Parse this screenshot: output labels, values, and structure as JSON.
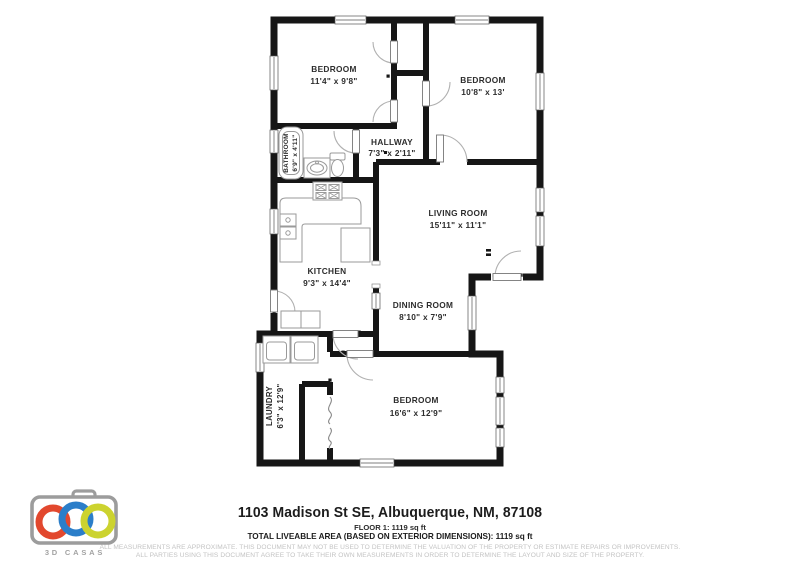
{
  "floor_plan": {
    "rooms": [
      {
        "name": "BEDROOM",
        "dims": "11'4\" x 9'8\""
      },
      {
        "name": "BEDROOM",
        "dims": "10'8\" x 13'"
      },
      {
        "name": "BATHROOM",
        "dims": "6'9\" x 4'11\""
      },
      {
        "name": "HALLWAY",
        "dims": "7'3\" x 2'11\""
      },
      {
        "name": "LIVING ROOM",
        "dims": "15'11\" x 11'1\""
      },
      {
        "name": "KITCHEN",
        "dims": "9'3\" x 14'4\""
      },
      {
        "name": "DINING ROOM",
        "dims": "8'10\" x 7'9\""
      },
      {
        "name": "LAUNDRY",
        "dims": "6'3\" x 12'9\""
      },
      {
        "name": "BEDROOM",
        "dims": "16'6\" x 12'9\""
      }
    ],
    "wall_color": "#161616"
  },
  "footer": {
    "address": "1103 Madison St SE, Albuquerque, NM, 87108",
    "floor_line": "FLOOR 1: 1119 sq ft",
    "total_line": "TOTAL LIVEABLE AREA (BASED ON EXTERIOR DIMENSIONS): 1119 sq ft",
    "disclaimer_line1": "ALL MEASUREMENTS ARE APPROXIMATE. THIS DOCUMENT MAY NOT BE USED TO DETERMINE THE VALUATION OF THE PROPERTY OR ESTIMATE REPAIRS OR IMPROVEMENTS.",
    "disclaimer_line2": "ALL PARTIES USING THIS DOCUMENT AGREE TO TAKE THEIR OWN MEASUREMENTS IN ORDER TO DETERMINE THE LAYOUT AND SIZE OF THE PROPERTY."
  },
  "logo": {
    "text": "3D CASAS",
    "camera_gray": "#9c9c9c",
    "ring_red": "#e2482e",
    "ring_blue": "#2b7ec9",
    "ring_yellow": "#ccd32f"
  }
}
